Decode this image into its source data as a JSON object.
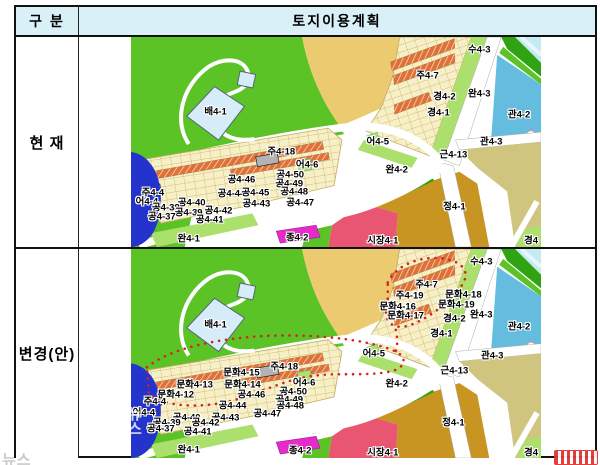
{
  "table": {
    "header": {
      "category_col": "구 분",
      "plan_col": "토지이용계획"
    },
    "rows": [
      {
        "label": "현 재",
        "map": "current"
      },
      {
        "label": "변경(안)",
        "map": "proposed"
      }
    ]
  },
  "colors": {
    "headerBg": "#d8f0f6",
    "halo": "#ffffff",
    "park": "#5cc327",
    "buffer": "#abe06c",
    "strip": "#2fa312",
    "sand": "#eccb70",
    "olive": "#cfc57f",
    "water": "#c4eaf4",
    "waterStripe": "#e6f6fb",
    "blue": "#64bcdf",
    "navy": "#2433cb",
    "paleBlue": "#d6edf9",
    "cream": "#f7f0c6",
    "lot": "#c3ab62",
    "orange": "#e0703a",
    "ochre": "#c89522",
    "market": "#e85672",
    "magenta": "#e62cc8",
    "grayBox": "#b3b3b3",
    "road": "#ffffff",
    "roadEdge": "#aaaaaa",
    "redDot": "#d42222"
  },
  "maps": {
    "current": {
      "red_boundary": false,
      "labels": [
        {
          "t": "배4-1",
          "x": 85,
          "y": 76
        },
        {
          "t": "수4-3",
          "x": 350,
          "y": 13
        },
        {
          "t": "주4-7",
          "x": 298,
          "y": 39
        },
        {
          "t": "경4-2",
          "x": 315,
          "y": 61
        },
        {
          "t": "완4-3",
          "x": 350,
          "y": 58
        },
        {
          "t": "경4-1",
          "x": 309,
          "y": 77
        },
        {
          "t": "관4-2",
          "x": 390,
          "y": 79
        },
        {
          "t": "어4-5",
          "x": 248,
          "y": 106
        },
        {
          "t": "관4-3",
          "x": 362,
          "y": 106
        },
        {
          "t": "근4-13",
          "x": 324,
          "y": 119
        },
        {
          "t": "완4-2",
          "x": 267,
          "y": 134
        },
        {
          "t": "주4-18",
          "x": 151,
          "y": 116
        },
        {
          "t": "어4-6",
          "x": 177,
          "y": 129
        },
        {
          "t": "공4-50",
          "x": 160,
          "y": 139
        },
        {
          "t": "공4-46",
          "x": 111,
          "y": 144
        },
        {
          "t": "공4-49",
          "x": 159,
          "y": 148
        },
        {
          "t": "주4-4",
          "x": 22,
          "y": 157
        },
        {
          "t": "공4-44",
          "x": 101,
          "y": 158
        },
        {
          "t": "공4-45",
          "x": 125,
          "y": 157
        },
        {
          "t": "공4-48",
          "x": 164,
          "y": 156
        },
        {
          "t": "어4-4",
          "x": 16,
          "y": 167
        },
        {
          "t": "공4-40",
          "x": 61,
          "y": 168
        },
        {
          "t": "공4-43",
          "x": 126,
          "y": 169
        },
        {
          "t": "공4-47",
          "x": 170,
          "y": 168
        },
        {
          "t": "공4-38",
          "x": 35,
          "y": 173
        },
        {
          "t": "공4-39",
          "x": 58,
          "y": 178
        },
        {
          "t": "공4-42",
          "x": 88,
          "y": 176
        },
        {
          "t": "공4-37",
          "x": 31,
          "y": 182
        },
        {
          "t": "공4-41",
          "x": 79,
          "y": 185
        },
        {
          "t": "완4-1",
          "x": 58,
          "y": 204
        },
        {
          "t": "종4-2",
          "x": 167,
          "y": 203
        },
        {
          "t": "시장4-1",
          "x": 253,
          "y": 206
        },
        {
          "t": "정4-1",
          "x": 325,
          "y": 172
        },
        {
          "t": "경4",
          "x": 402,
          "y": 206
        }
      ]
    },
    "proposed": {
      "red_boundary": true,
      "labels": [
        {
          "t": "배4-1",
          "x": 85,
          "y": 77
        },
        {
          "t": "수4-3",
          "x": 352,
          "y": 13
        },
        {
          "t": "주4-7",
          "x": 297,
          "y": 37
        },
        {
          "t": "주4-19",
          "x": 280,
          "y": 48
        },
        {
          "t": "문화4-18",
          "x": 334,
          "y": 47
        },
        {
          "t": "문화4-16",
          "x": 268,
          "y": 59
        },
        {
          "t": "문화4-19",
          "x": 327,
          "y": 57
        },
        {
          "t": "문화4-17",
          "x": 276,
          "y": 68
        },
        {
          "t": "경4-2",
          "x": 325,
          "y": 71
        },
        {
          "t": "완4-3",
          "x": 352,
          "y": 67
        },
        {
          "t": "경4-1",
          "x": 312,
          "y": 86
        },
        {
          "t": "관4-2",
          "x": 390,
          "y": 79
        },
        {
          "t": "어4-5",
          "x": 244,
          "y": 107
        },
        {
          "t": "관4-3",
          "x": 363,
          "y": 109
        },
        {
          "t": "근4-13",
          "x": 325,
          "y": 124
        },
        {
          "t": "완4-2",
          "x": 267,
          "y": 137
        },
        {
          "t": "문화4-15",
          "x": 111,
          "y": 126
        },
        {
          "t": "주4-18",
          "x": 154,
          "y": 120
        },
        {
          "t": "문화4-13",
          "x": 64,
          "y": 138
        },
        {
          "t": "문화4-14",
          "x": 112,
          "y": 138
        },
        {
          "t": "어4-6",
          "x": 174,
          "y": 136
        },
        {
          "t": "문화4-12",
          "x": 45,
          "y": 148
        },
        {
          "t": "공4-50",
          "x": 163,
          "y": 145
        },
        {
          "t": "공4-46",
          "x": 121,
          "y": 148
        },
        {
          "t": "공4-49",
          "x": 159,
          "y": 153
        },
        {
          "t": "주4-4",
          "x": 24,
          "y": 155
        },
        {
          "t": "공4-44",
          "x": 102,
          "y": 159
        },
        {
          "t": "공4-48",
          "x": 160,
          "y": 159
        },
        {
          "t": "어4-4",
          "x": 13,
          "y": 166
        },
        {
          "t": "공4-40",
          "x": 56,
          "y": 171
        },
        {
          "t": "공4-43",
          "x": 95,
          "y": 171
        },
        {
          "t": "공4-47",
          "x": 137,
          "y": 167
        },
        {
          "t": "공4-39",
          "x": 36,
          "y": 176
        },
        {
          "t": "공4-42",
          "x": 75,
          "y": 177
        },
        {
          "t": "공4-37",
          "x": 30,
          "y": 183
        },
        {
          "t": "공4-41",
          "x": 67,
          "y": 186
        },
        {
          "t": "완4-1",
          "x": 58,
          "y": 204
        },
        {
          "t": "종4-2",
          "x": 170,
          "y": 205
        },
        {
          "t": "시장4-1",
          "x": 253,
          "y": 207
        },
        {
          "t": "정4-1",
          "x": 324,
          "y": 177
        },
        {
          "t": "경4",
          "x": 402,
          "y": 207
        }
      ]
    }
  },
  "watermarks": {
    "on_map_text": "뉴스",
    "bottom_left_text": "뉴스"
  }
}
